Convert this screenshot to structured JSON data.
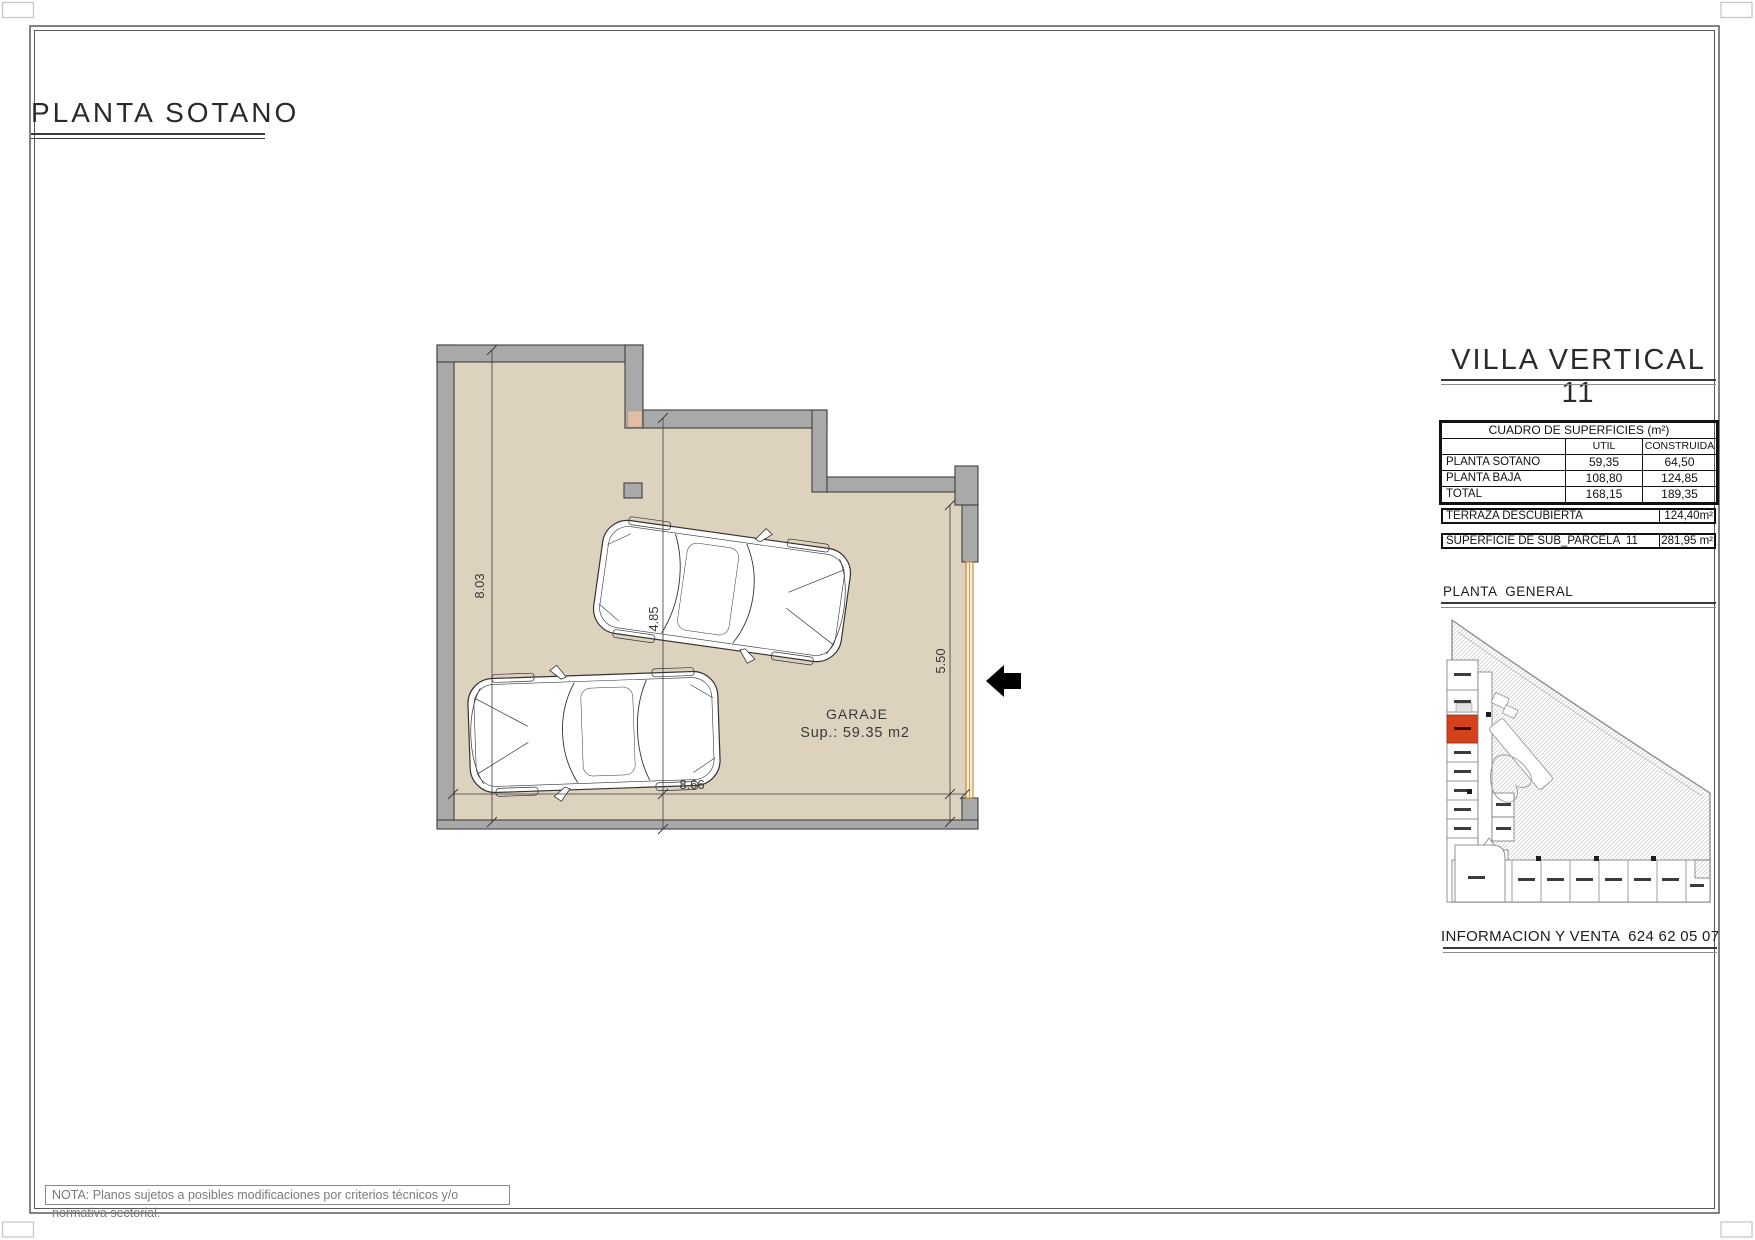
{
  "page": {
    "title": "PLANTA SOTANO",
    "note": "NOTA: Planos sujetos a posibles modificaciones por criterios técnicos y/o normativa sectorial."
  },
  "plan": {
    "room": "GARAJE",
    "area": "Sup.: 59.35 m2",
    "dim_left": "8.03",
    "dim_mid": "4.85",
    "dim_right": "5.50",
    "dim_bottom": "8.66"
  },
  "panel": {
    "title": "VILLA VERTICAL 11",
    "table": {
      "title": "CUADRO DE SUPERFICIES (m²)",
      "col_util": "UTIL",
      "col_construida": "CONSTRUIDA",
      "rows": [
        {
          "label": "PLANTA SOTANO",
          "util": "59,35",
          "cons": "64,50"
        },
        {
          "label": "PLANTA BAJA",
          "util": "108,80",
          "cons": "124,85"
        },
        {
          "label": "TOTAL",
          "util": "168,15",
          "cons": "189,35"
        }
      ]
    },
    "terraza_label": "TERRAZA DESCUBIERTA",
    "terraza_value": "124,40m²",
    "parcela_label": "SUPERFICIE DE SUB_PARCELA  11",
    "parcela_value": "281,95 m²",
    "general_title": "PLANTA  GENERAL",
    "contact": "INFORMACION Y VENTA  624 62 05 07"
  },
  "colors": {
    "floor": "#ddd2bd",
    "wall": "#a9a9a9",
    "outline": "#3f3f3f",
    "door_line": "#bf7b2e",
    "door_fill": "#f8eccb",
    "highlight_unit": "#d4421c",
    "hatch": "#c9c9c9",
    "frame": "#5a5a5a"
  }
}
